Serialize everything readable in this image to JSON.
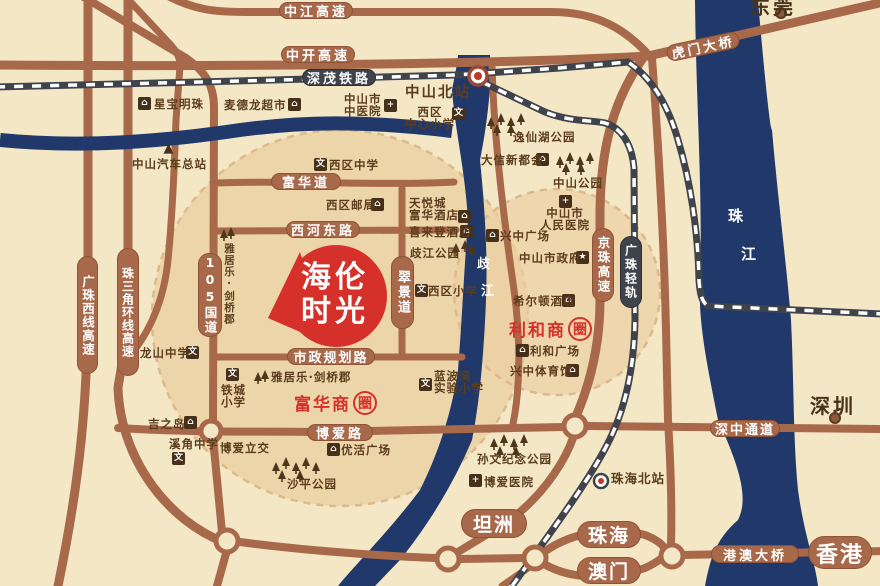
{
  "badge": {
    "line1": "海伦",
    "line2": "时光",
    "color": "#D5302A"
  },
  "zones": {
    "fuhua": {
      "prefix": "富华商",
      "circled": "圈"
    },
    "lihe": {
      "prefix": "利和商",
      "circled": "圈"
    }
  },
  "roads": {
    "zhongjiang": "中江高速",
    "zhongkai": "中开高速",
    "humen": "虎门大桥",
    "fuhuadao": "富华道",
    "xihedonglu": "西河东路",
    "shizheng": "市政规划路",
    "boailu": "博爱路",
    "shenzhong": "深中通道",
    "gangao": "港澳大桥",
    "guodao105": "105国道",
    "cuijingdao": "翠景道",
    "jingzhu": "京珠高速",
    "zhusanjiao": "珠三角环线高速",
    "guangzhuxi": "广珠西线高速"
  },
  "railways": {
    "shenmao": "深茂铁路",
    "guangzhu": "广珠轻轨"
  },
  "stations": {
    "zhongshanbei": "中山北站",
    "zhuhaibei": "珠海北站"
  },
  "cities": {
    "dongguan": "东莞",
    "shenzhen": "深圳",
    "tanzhou": "坦洲",
    "zhuhai": "珠海",
    "aomen": "澳门",
    "xianggang": "香港"
  },
  "rivers": {
    "zhujiang": {
      "ch1": "珠",
      "ch2": "江"
    },
    "qijiang": {
      "ch1": "歧",
      "ch2": "江"
    }
  },
  "icons": {
    "building": "⌂",
    "school": "文",
    "hospital": "+",
    "government": "★",
    "bus": "▲"
  },
  "pois": {
    "xingbao": {
      "label": "星宝明珠"
    },
    "maidelong": {
      "label": "麦德龙超市"
    },
    "zhongyiyuan": {
      "line1": "中山市",
      "line2": "中医院"
    },
    "qiche": {
      "label": "中山汽车总站"
    },
    "xiqu_zhongxin": {
      "line1": "西区",
      "line2": "中心小学"
    },
    "yixianhu": {
      "label": "逸仙湖公园"
    },
    "daxin": {
      "label": "大信新都会"
    },
    "zhongshan_gy": {
      "label": "中山公园"
    },
    "xiqu_zhongxue": {
      "label": "西区中学"
    },
    "xiqu_youju": {
      "label": "西区邮局"
    },
    "tianyue": {
      "line1": "天悦城",
      "line2": "富华酒店"
    },
    "xilaideng": {
      "label": "喜来登酒店"
    },
    "qijiang_gy": {
      "label": "歧江公园"
    },
    "xingzhong_gc": {
      "label": "兴中广场"
    },
    "renmin": {
      "line1": "中山市",
      "line2": "人民医院"
    },
    "zhengfu": {
      "label": "中山市政府"
    },
    "xierdun": {
      "label": "希尔顿酒店"
    },
    "lihe_gc": {
      "label": "利和广场"
    },
    "xingzhong_ty": {
      "label": "兴中体育馆"
    },
    "xiqu_xiaoxue": {
      "label": "西区小学"
    },
    "yajule_v": {
      "label": "雅居乐·剑桥郡"
    },
    "longshan": {
      "label": "龙山中学"
    },
    "tiecheng": {
      "line1": "铁城",
      "line2": "小学"
    },
    "jizhidao": {
      "label": "吉之岛"
    },
    "xijiao": {
      "label": "溪角中学"
    },
    "boai_lijiao": {
      "label": "博爱立交"
    },
    "yajule_h": {
      "label": "雅居乐·剑桥郡"
    },
    "lanbowan": {
      "line1": "蓝波湾",
      "line2": "实验小学"
    },
    "youhuo": {
      "label": "优活广场"
    },
    "shaping": {
      "label": "沙平公园"
    },
    "sunwen": {
      "label": "孙文纪念公园"
    },
    "boai_yy": {
      "label": "博爱医院"
    }
  },
  "colors": {
    "background": "#F3E7C6",
    "zone_fill": "#EBCFA2",
    "road": "#A8694B",
    "railway": "#3F434B",
    "river": "#21386B",
    "accent_red": "#D5302A",
    "text_brown": "#5B3D1D"
  }
}
